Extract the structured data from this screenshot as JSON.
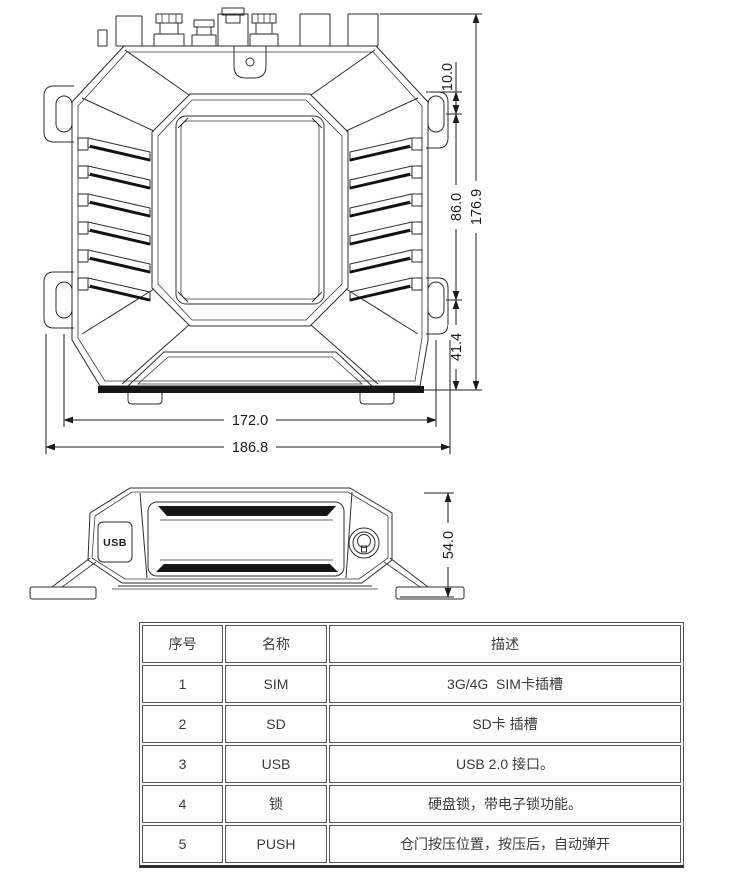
{
  "dims": {
    "d10": "10.0",
    "d86": "86.0",
    "d176": "176.9",
    "d414": "41.4",
    "d172": "172.0",
    "d186": "186.8",
    "d54": "54.0"
  },
  "side_view": {
    "usb_label": "USB"
  },
  "table": {
    "headers": [
      "序号",
      "名称",
      "描述"
    ],
    "rows": [
      {
        "no": "1",
        "name": "SIM",
        "desc": "3G/4G  SIM卡插槽"
      },
      {
        "no": "2",
        "name": "SD",
        "desc": "SD卡 插槽"
      },
      {
        "no": "3",
        "name": "USB",
        "desc": "USB 2.0 接口。"
      },
      {
        "no": "4",
        "name": "锁",
        "desc": "硬盘锁，带电子锁功能。"
      },
      {
        "no": "5",
        "name": "PUSH",
        "desc": "仓门按压位置，按压后，自动弹开"
      }
    ]
  },
  "colors": {
    "line": "#2d2d2d",
    "dark_fill": "#161616",
    "table_border": "#4c4c4c",
    "text": "#3a3a3a"
  }
}
